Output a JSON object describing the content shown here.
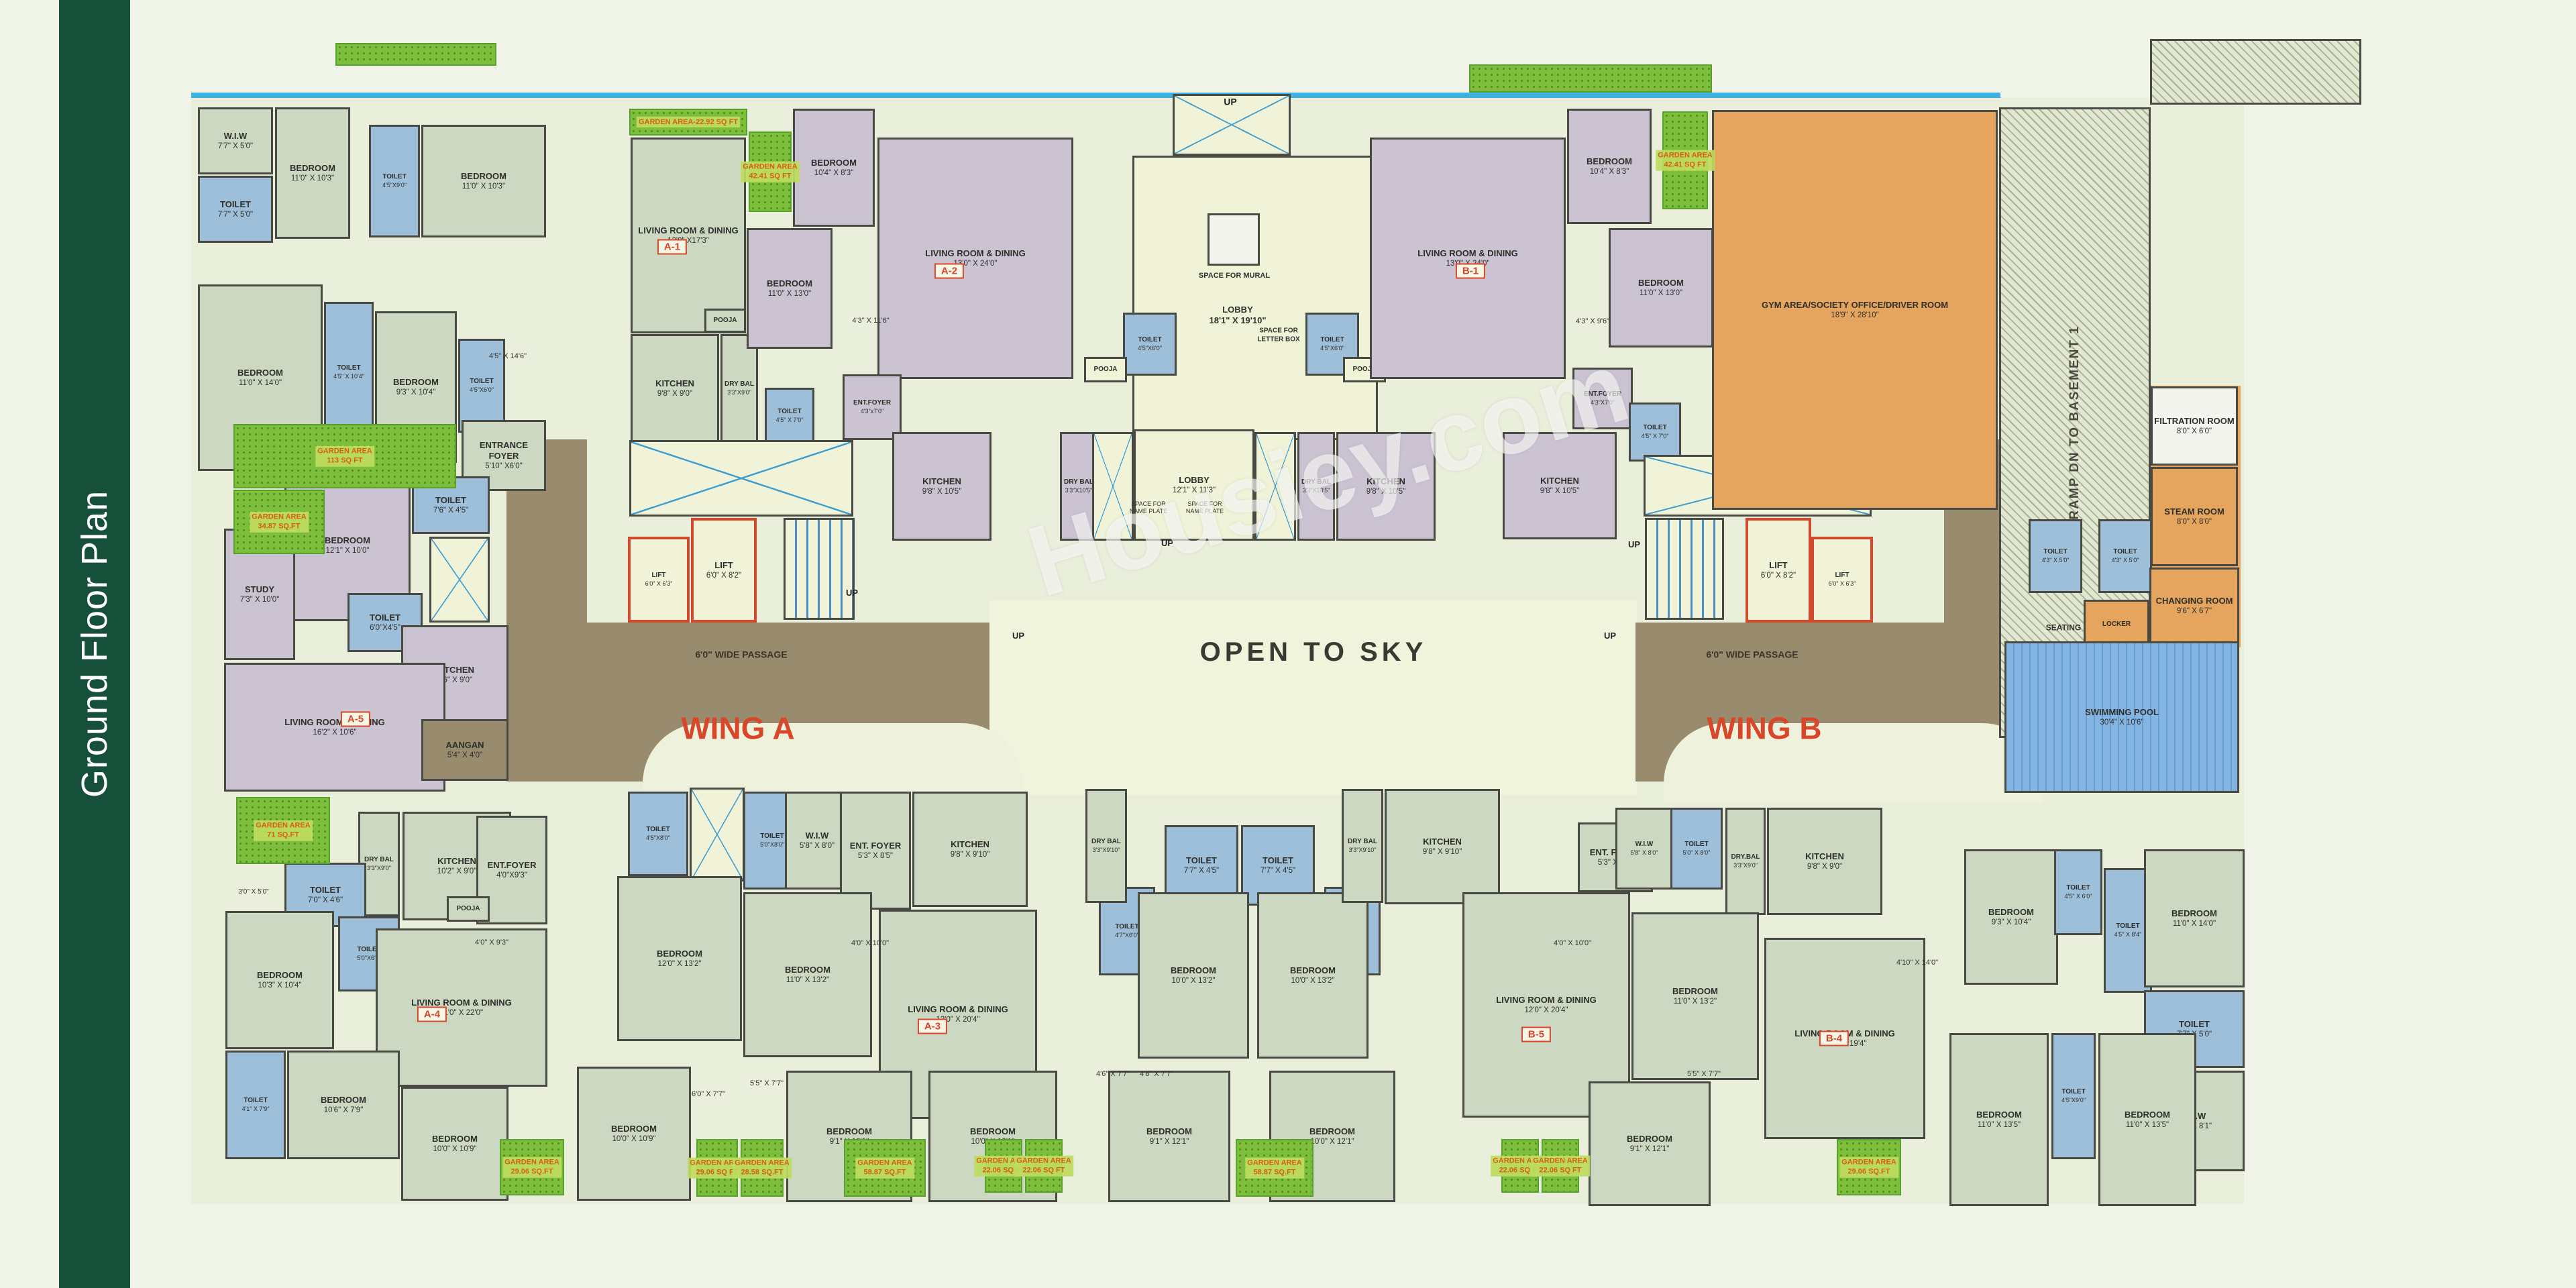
{
  "sidebar": {
    "title": "Ground Floor Plan"
  },
  "watermark": {
    "text": "Housiey.com"
  },
  "palette": {
    "sidebar_green": "#17503a",
    "wall": "#4a4a44",
    "accent_red": "#d9472b",
    "toilet_blue": "#9dbfda",
    "unit_green": "#ccd8c2",
    "unit_purple": "#cbc2d2",
    "passage_brown": "#998b6e",
    "amenity_orange": "#e6a55e",
    "garden_green": "#7dbf3c",
    "pool_blue": "#84b5e2"
  },
  "zones": [
    [
      "e",
      285,
      145,
      3060,
      1650
    ],
    [
      "bl",
      285,
      138,
      2697,
      8
    ],
    [
      "sky",
      1475,
      895,
      965,
      290
    ],
    [
      "brown",
      875,
      928,
      600,
      237
    ],
    [
      "brown",
      755,
      655,
      120,
      510
    ],
    [
      "brown",
      2438,
      928,
      575,
      237
    ],
    [
      "brown",
      2898,
      655,
      112,
      280
    ],
    [
      "o",
      2988,
      764,
      350,
      192
    ],
    [
      "o",
      3204,
      575,
      136,
      390
    ],
    [
      "arc",
      958,
      1078,
      565,
      118
    ],
    [
      "arc",
      2480,
      1078,
      565,
      118
    ]
  ],
  "rooms": [
    [
      "W.I.W",
      "7'7\" X 5'0\"",
      "g",
      295,
      160,
      112,
      100
    ],
    [
      "TOILET",
      "7'7\" X 5'0\"",
      "b",
      295,
      262,
      112,
      100
    ],
    [
      "BEDROOM",
      "11'0\" X 10'3\"",
      "g",
      410,
      160,
      112,
      196
    ],
    [
      "TOILET",
      "4'5\"X9'0\"",
      "b",
      550,
      186,
      76,
      168
    ],
    [
      "BEDROOM",
      "11'0\" X 10'3\"",
      "g",
      628,
      186,
      186,
      168
    ],
    [
      "BEDROOM",
      "11'0\" X 14'0\"",
      "g",
      295,
      424,
      186,
      278
    ],
    [
      "TOILET",
      "4'5\" X 10'4\"",
      "b",
      483,
      450,
      74,
      210
    ],
    [
      "BEDROOM",
      "9'3\" X 10'4\"",
      "g",
      559,
      464,
      122,
      226
    ],
    [
      "TOILET",
      "4'5\"X6'0\"",
      "b",
      683,
      505,
      70,
      140
    ],
    [
      "LIVING ROOM & DINING",
      "13'0\" X17'3\"",
      "g",
      940,
      205,
      172,
      292
    ],
    [
      "POOJA",
      "",
      "g",
      1050,
      460,
      62,
      36
    ],
    [
      "KITCHEN",
      "9'8\" X 9'0\"",
      "g",
      940,
      498,
      132,
      162
    ],
    [
      "DRY BAL",
      "3'3\"X9'0\"",
      "g",
      1074,
      498,
      56,
      162
    ],
    [
      "TOILET",
      "4'5\" X 7'0\"",
      "b",
      1140,
      578,
      74,
      84
    ],
    [
      "BEDROOM",
      "10'4\" X 8'3\"",
      "p",
      1182,
      162,
      122,
      176
    ],
    [
      "BEDROOM",
      "11'0\" X 13'0\"",
      "p",
      1113,
      340,
      128,
      180
    ],
    [
      "LIVING ROOM & DINING",
      "13'0\" X 24'0\"",
      "p",
      1308,
      205,
      292,
      360
    ],
    [
      "ENT.FOYER",
      "4'3\"x7'0\"",
      "p",
      1256,
      558,
      88,
      98
    ],
    [
      "KITCHEN",
      "9'8\" X 10'5\"",
      "p",
      1330,
      644,
      148,
      162
    ],
    [
      "DRY BAL",
      "3'3\"X10'5\"",
      "p",
      1580,
      644,
      56,
      162
    ],
    [
      "",
      "",
      "shaft",
      1748,
      140,
      176,
      92
    ],
    [
      "",
      "",
      "c",
      1688,
      232,
      366,
      424
    ],
    [
      "",
      "",
      "w",
      1800,
      318,
      78,
      78
    ],
    [
      "TOILET",
      "4'5\"X6'0\"",
      "b",
      1674,
      466,
      80,
      94
    ],
    [
      "POOJA",
      "",
      "c",
      1616,
      532,
      64,
      38
    ],
    [
      "TOILET",
      "4'5\"X6'0\"",
      "b",
      1946,
      466,
      80,
      94
    ],
    [
      "POOJA",
      "",
      "c",
      2002,
      532,
      64,
      38
    ],
    [
      "",
      "",
      "shaft",
      1628,
      644,
      62,
      162
    ],
    [
      "LOBBY",
      "12'1\" X 11'3\"",
      "c",
      1690,
      640,
      180,
      166
    ],
    [
      "",
      "",
      "shaft",
      1870,
      644,
      62,
      162
    ],
    [
      "DRY BAL",
      "3'3\"X10'5\"",
      "p",
      1934,
      644,
      56,
      162
    ],
    [
      "KITCHEN",
      "9'8\" X 10'5\"",
      "p",
      1992,
      644,
      148,
      162
    ],
    [
      "LIVING ROOM & DINING",
      "13'0\" X 24'0\"",
      "p",
      2042,
      205,
      292,
      360
    ],
    [
      "BEDROOM",
      "10'4\" X 8'3\"",
      "p",
      2336,
      162,
      126,
      172
    ],
    [
      "BEDROOM",
      "11'0\" X 13'0\"",
      "p",
      2398,
      340,
      156,
      178
    ],
    [
      "ENT.FOYER",
      "4'3\"X7'0\"",
      "p",
      2344,
      548,
      90,
      92
    ],
    [
      "TOILET",
      "4'5\" X 7'0\"",
      "b",
      2428,
      600,
      78,
      88
    ],
    [
      "TOILET",
      "4'5\" X 7'0\"",
      "b",
      2556,
      566,
      74,
      88
    ],
    [
      "KITCHEN",
      "9'8\" X 10'5\"",
      "p",
      2240,
      644,
      170,
      160
    ],
    [
      "",
      "",
      "shaft",
      2450,
      678,
      340,
      92
    ],
    [
      "",
      "",
      "stair",
      2452,
      772,
      118,
      152
    ],
    [
      "LIFT",
      "6'0\" X 8'2\"",
      "lift",
      2602,
      772,
      98,
      156
    ],
    [
      "LIFT",
      "6'0\" X 6'3\"",
      "lift",
      2700,
      800,
      92,
      128
    ],
    [
      "",
      "",
      "shaft",
      938,
      656,
      334,
      114
    ],
    [
      "LIFT",
      "6'0\" X 6'3\"",
      "lift",
      936,
      800,
      92,
      128
    ],
    [
      "LIFT",
      "6'0\" X 8'2\"",
      "lift",
      1030,
      772,
      98,
      156
    ],
    [
      "",
      "",
      "stair",
      1168,
      772,
      106,
      152
    ],
    [
      "ENTRANCE FOYER",
      "5'10\" X6'0\"",
      "g",
      688,
      626,
      126,
      106
    ],
    [
      "BEDROOM",
      "12'1\" X 10'0\"",
      "p",
      424,
      700,
      188,
      226
    ],
    [
      "STUDY",
      "7'3\" X 10'0\"",
      "p",
      334,
      788,
      106,
      196
    ],
    [
      "TOILET",
      "7'6\" X 4'5\"",
      "b",
      614,
      710,
      116,
      86
    ],
    [
      "",
      "",
      "shaft",
      640,
      800,
      90,
      128
    ],
    [
      "TOILET",
      "6'0\"X4'5\"",
      "b",
      518,
      884,
      112,
      88
    ],
    [
      "KITCHEN",
      "8'6\" X 9'0\"",
      "p",
      598,
      932,
      160,
      148
    ],
    [
      "LIVING ROOM & DINING",
      "16'2\" X 10'6\"",
      "p",
      334,
      988,
      330,
      192
    ],
    [
      "AANGAN",
      "5'4\" X 4'0\"",
      "brown",
      628,
      1072,
      130,
      92
    ],
    [
      "GYM AREA/SOCIETY\nOFFICE/DRIVER ROOM",
      "18'9\" X 28'10\"",
      "o",
      2552,
      164,
      426,
      596
    ],
    [
      "RAMP DN TO BASEMENT 1",
      "",
      "ramp",
      2980,
      160,
      226,
      940,
      "v"
    ],
    [
      "",
      "",
      "ramp",
      3205,
      58,
      315,
      98
    ],
    [
      "FILTRATION ROOM",
      "8'0\" X 6'0\"",
      "w",
      3206,
      576,
      130,
      118
    ],
    [
      "STEAM ROOM",
      "8'0\" X 8'0\"",
      "o",
      3206,
      696,
      130,
      148
    ],
    [
      "TOILET",
      "4'3\" X 5'0\"",
      "b",
      3024,
      774,
      80,
      110
    ],
    [
      "TOILET",
      "4'3\" X 5'0\"",
      "b",
      3128,
      774,
      80,
      110
    ],
    [
      "CHANGING ROOM",
      "9'6\" X 6'7\"",
      "o",
      3204,
      846,
      134,
      114
    ],
    [
      "LOCKER",
      "",
      "o",
      3106,
      894,
      98,
      74
    ],
    [
      "SWIMMING POOL",
      "30'4\" X 10'6\"",
      "pool",
      2988,
      956,
      350,
      226
    ],
    [
      "DRY BAL",
      "3'3\"X9'0\"",
      "g",
      534,
      1210,
      62,
      156
    ],
    [
      "KITCHEN",
      "10'2\" X 9'0\"",
      "g",
      600,
      1210,
      162,
      162
    ],
    [
      "ENT.FOYER",
      "4'0\"X9'3\"",
      "g",
      710,
      1216,
      106,
      162
    ],
    [
      "TOILET",
      "7'0\" X 4'6\"",
      "b",
      424,
      1286,
      122,
      96
    ],
    [
      "TOILET",
      "5'0\"X6'0\"",
      "b",
      504,
      1366,
      92,
      112
    ],
    [
      "BEDROOM",
      "10'3\" X 10'4\"",
      "g",
      336,
      1358,
      162,
      206
    ],
    [
      "POOJA",
      "",
      "g",
      666,
      1336,
      64,
      38
    ],
    [
      "LIVING ROOM & DINING",
      "11'0\" X 22'0\"",
      "g",
      560,
      1384,
      256,
      236
    ],
    [
      "TOILET",
      "4'1\" X 7'9\"",
      "b",
      336,
      1566,
      90,
      162
    ],
    [
      "BEDROOM",
      "10'6\" X 7'9\"",
      "g",
      428,
      1566,
      168,
      162
    ],
    [
      "BEDROOM",
      "10'0\" X 10'9\"",
      "g",
      598,
      1620,
      160,
      170
    ],
    [
      "BEDROOM",
      "10'0\" X 10'9\"",
      "g",
      860,
      1590,
      170,
      200
    ],
    [
      "TOILET",
      "4'5\"X8'0\"",
      "b",
      936,
      1180,
      90,
      126
    ],
    [
      "",
      "",
      "shaft",
      1028,
      1174,
      82,
      140
    ],
    [
      "TOILET",
      "5'0\"X8'0\"",
      "b",
      1108,
      1180,
      86,
      146
    ],
    [
      "W.I.W",
      "5'8\" X 8'0\"",
      "g",
      1170,
      1180,
      96,
      146
    ],
    [
      "ENT. FOYER",
      "5'3\" X 8'5\"",
      "g",
      1252,
      1180,
      106,
      176
    ],
    [
      "KITCHEN",
      "9'8\" X 9'10\"",
      "g",
      1360,
      1180,
      172,
      172
    ],
    [
      "BEDROOM",
      "12'0\" X 13'2\"",
      "g",
      920,
      1306,
      186,
      246
    ],
    [
      "BEDROOM",
      "11'0\" X 13'2\"",
      "g",
      1108,
      1330,
      192,
      246
    ],
    [
      "LIVING ROOM & DINING",
      "12'0\" X 20'4\"",
      "g",
      1310,
      1356,
      236,
      312
    ],
    [
      "BEDROOM",
      "9'1\" X 12'1\"",
      "g",
      1172,
      1596,
      188,
      196
    ],
    [
      "BEDROOM",
      "10'0\" X 12'1\"",
      "g",
      1384,
      1596,
      192,
      196
    ],
    [
      "TOILET",
      "7'7\" X 4'5\"",
      "b",
      1736,
      1230,
      110,
      120
    ],
    [
      "TOILET",
      "7'7\" X 4'5\"",
      "b",
      1850,
      1230,
      110,
      120
    ],
    [
      "TOILET",
      "4'7\"X6'0\"",
      "b",
      1638,
      1322,
      84,
      132
    ],
    [
      "TOILET",
      "4'7\"X6'0\"",
      "b",
      1974,
      1322,
      84,
      132
    ],
    [
      "BEDROOM",
      "10'0\" X 13'2\"",
      "g",
      1696,
      1330,
      166,
      248
    ],
    [
      "BEDROOM",
      "10'0\" X 13'2\"",
      "g",
      1874,
      1330,
      166,
      248
    ],
    [
      "DRY BAL",
      "3'3\"X9'10\"",
      "g",
      1618,
      1176,
      62,
      170
    ],
    [
      "DRY BAL",
      "3'3\"X9'10\"",
      "g",
      2000,
      1176,
      62,
      170
    ],
    [
      "KITCHEN",
      "9'8\" X 9'10\"",
      "g",
      2064,
      1176,
      172,
      172
    ],
    [
      "BEDROOM",
      "9'1\" X 12'1\"",
      "g",
      1652,
      1596,
      182,
      196
    ],
    [
      "BEDROOM",
      "10'0\" X 12'1\"",
      "g",
      1892,
      1596,
      188,
      196
    ],
    [
      "LIVING ROOM & DINING",
      "12'0\" X 20'4\"",
      "g",
      2180,
      1330,
      250,
      336
    ],
    [
      "ENT. FOYER",
      "5'3\" X 8'5\"",
      "g",
      2352,
      1226,
      112,
      104
    ],
    [
      "W.I.W",
      "5'8\" X 8'0\"",
      "g",
      2408,
      1204,
      86,
      122
    ],
    [
      "TOILET",
      "5'0\" X 8'0\"",
      "b",
      2490,
      1204,
      78,
      122
    ],
    [
      "DRY.BAL",
      "3'3\"X9'0\"",
      "g",
      2572,
      1204,
      60,
      160
    ],
    [
      "KITCHEN",
      "9'8\" X 9'0\"",
      "g",
      2634,
      1204,
      172,
      160
    ],
    [
      "BEDROOM",
      "11'0\" X 13'2\"",
      "g",
      2432,
      1360,
      190,
      250
    ],
    [
      "LIVING ROOM & DINING",
      "13'0\" X 19'4\"",
      "g",
      2630,
      1398,
      240,
      300
    ],
    [
      "BEDROOM",
      "9'1\" X 12'1\"",
      "g",
      2368,
      1612,
      182,
      186
    ],
    [
      "BEDROOM",
      "9'3\" X 10'4\"",
      "g",
      2928,
      1266,
      140,
      202
    ],
    [
      "TOILET",
      "4'5\" X 6'0\"",
      "b",
      3062,
      1266,
      72,
      128
    ],
    [
      "TOILET",
      "4'5\" X 8'4\"",
      "b",
      3136,
      1294,
      72,
      186
    ],
    [
      "BEDROOM",
      "11'0\" X 14'0\"",
      "g",
      3196,
      1266,
      150,
      206
    ],
    [
      "TOILET",
      "7'7\" X 5'0\"",
      "b",
      3196,
      1476,
      150,
      116
    ],
    [
      "W.I.W",
      "7'7\" X 8'1\"",
      "g",
      3196,
      1596,
      150,
      150
    ],
    [
      "BEDROOM",
      "11'0\" X 13'5\"",
      "g",
      2906,
      1540,
      148,
      258
    ],
    [
      "TOILET",
      "4'5\"X9'0\"",
      "b",
      3058,
      1540,
      66,
      188
    ],
    [
      "BEDROOM",
      "11'0\" X 13'5\"",
      "g",
      3128,
      1540,
      146,
      258
    ]
  ],
  "gardens": [
    [
      "GARDEN AREA",
      "113 SQ FT",
      348,
      632,
      332,
      96
    ],
    [
      "GARDEN AREA",
      "34.87 SQ.FT",
      348,
      730,
      136,
      96
    ],
    [
      "GARDEN AREA",
      "71 SQ.FT",
      352,
      1188,
      140,
      100
    ],
    [
      "GARDEN AREA-22.92 SQ FT",
      "",
      938,
      162,
      176,
      40
    ],
    [
      "GARDEN AREA",
      "42.41 SQ FT",
      1116,
      196,
      64,
      120
    ],
    [
      "GARDEN AREA",
      "42.41 SQ FT",
      2478,
      166,
      68,
      146
    ],
    [
      "GARDEN AREA",
      "29.06 SQ.FT",
      745,
      1698,
      96,
      84
    ],
    [
      "GARDEN AREA",
      "29.06 SQ FT",
      1038,
      1698,
      62,
      86
    ],
    [
      "GARDEN AREA",
      "28.58 SQ.FT",
      1104,
      1698,
      64,
      86
    ],
    [
      "GARDEN AREA",
      "58.87 SQ.FT",
      1258,
      1698,
      122,
      86
    ],
    [
      "GARDEN AREA",
      "22.06 SQ FT",
      1468,
      1698,
      56,
      80
    ],
    [
      "GARDEN AREA",
      "22.06 SQ FT",
      1528,
      1698,
      56,
      80
    ],
    [
      "GARDEN AREA",
      "58.87 SQ.FT",
      1842,
      1698,
      116,
      86
    ],
    [
      "GARDEN AREA",
      "22.06 SQ FT",
      2238,
      1698,
      56,
      80
    ],
    [
      "GARDEN AREA",
      "22.06 SQ FT",
      2298,
      1698,
      56,
      80
    ],
    [
      "GARDEN AREA",
      "29.06 SQ.FT",
      2738,
      1698,
      96,
      84
    ],
    [
      "",
      "",
      500,
      64,
      240,
      34
    ],
    [
      "",
      "",
      2190,
      96,
      362,
      42
    ]
  ],
  "labels": [
    [
      "UP",
      1834,
      152,
      14,
      "#222",
      0,
      1
    ],
    [
      "UP",
      1270,
      884,
      13,
      "#222",
      0,
      1
    ],
    [
      "UP",
      2436,
      812,
      13,
      "#222",
      0,
      1
    ],
    [
      "UP",
      1518,
      948,
      13,
      "#222",
      0,
      1
    ],
    [
      "UP",
      2400,
      948,
      13,
      "#222",
      0,
      1
    ],
    [
      "UP",
      1740,
      810,
      13,
      "#222",
      0,
      1
    ],
    [
      "6'0\" WIDE PASSAGE",
      1105,
      976,
      14,
      "#3a342a",
      0,
      1
    ],
    [
      "6'0\" WIDE PASSAGE",
      2612,
      976,
      14,
      "#3a342a",
      0,
      1
    ],
    [
      "OPEN TO SKY",
      1958,
      972,
      40,
      "#3a3a33",
      0,
      1
    ],
    [
      "SPACE FOR MURAL",
      1840,
      412,
      11,
      "#33332e",
      0,
      1
    ],
    [
      "LOBBY\n18'1\" X 19'10\"",
      1845,
      470,
      13,
      "#33332e",
      0,
      1
    ],
    [
      "SPACE FOR\nLETTER BOX",
      1906,
      500,
      10,
      "#33332e",
      0,
      1
    ],
    [
      "SPACE FOR\nNAME PLATE",
      1712,
      757,
      9,
      "#33332e",
      0,
      0
    ],
    [
      "SPACE FOR\nNAME PLATE",
      1796,
      757,
      9,
      "#33332e",
      0,
      0
    ],
    [
      "SEATING",
      3076,
      936,
      12,
      "#33332e",
      0,
      1
    ],
    [
      "4'5\" X 14'6\"",
      757,
      532,
      11,
      "#33332e",
      0,
      0
    ],
    [
      "4'3\" X 11'6\"",
      1298,
      479,
      11,
      "#33332e",
      0,
      0
    ],
    [
      "4'3\" X 9'6\"",
      2374,
      480,
      11,
      "#33332e",
      0,
      0
    ],
    [
      "3'0\" X 5'0\"",
      378,
      1330,
      10,
      "#33332e",
      0,
      0
    ],
    [
      "4'0\" X 9'3\"",
      733,
      1406,
      11,
      "#33332e",
      0,
      0
    ],
    [
      "4'0\" X 10'0\"",
      1297,
      1407,
      11,
      "#33332e",
      0,
      0
    ],
    [
      "4'0\" X 10'0\"",
      2344,
      1407,
      11,
      "#33332e",
      0,
      0
    ],
    [
      "5'5\" X 7'7\"",
      1143,
      1616,
      11,
      "#33332e",
      0,
      0
    ],
    [
      "6'0\" X 7'7\"",
      1056,
      1632,
      11,
      "#33332e",
      0,
      0
    ],
    [
      "4'6\" X 7'7\"",
      1659,
      1602,
      11,
      "#33332e",
      0,
      0
    ],
    [
      "4'6\" X 7'7\"",
      1724,
      1602,
      11,
      "#33332e",
      0,
      0
    ],
    [
      "4'10\" X 14'0\"",
      2858,
      1436,
      11,
      "#33332e",
      0,
      0
    ],
    [
      "5'5\" X 7'7\"",
      2540,
      1602,
      11,
      "#33332e",
      0,
      0
    ],
    [
      "WING A",
      1100,
      1086,
      46,
      "#d9472b",
      0,
      1
    ],
    [
      "WING B",
      2630,
      1086,
      46,
      "#d9472b",
      0,
      1
    ]
  ],
  "unit_tags": [
    [
      "A-1",
      1002,
      368
    ],
    [
      "A-2",
      1415,
      404
    ],
    [
      "A-3",
      1390,
      1530
    ],
    [
      "A-4",
      644,
      1512
    ],
    [
      "A-5",
      530,
      1072
    ],
    [
      "B-1",
      2192,
      404
    ],
    [
      "B-4",
      2734,
      1548
    ],
    [
      "B-5",
      2290,
      1542
    ]
  ]
}
